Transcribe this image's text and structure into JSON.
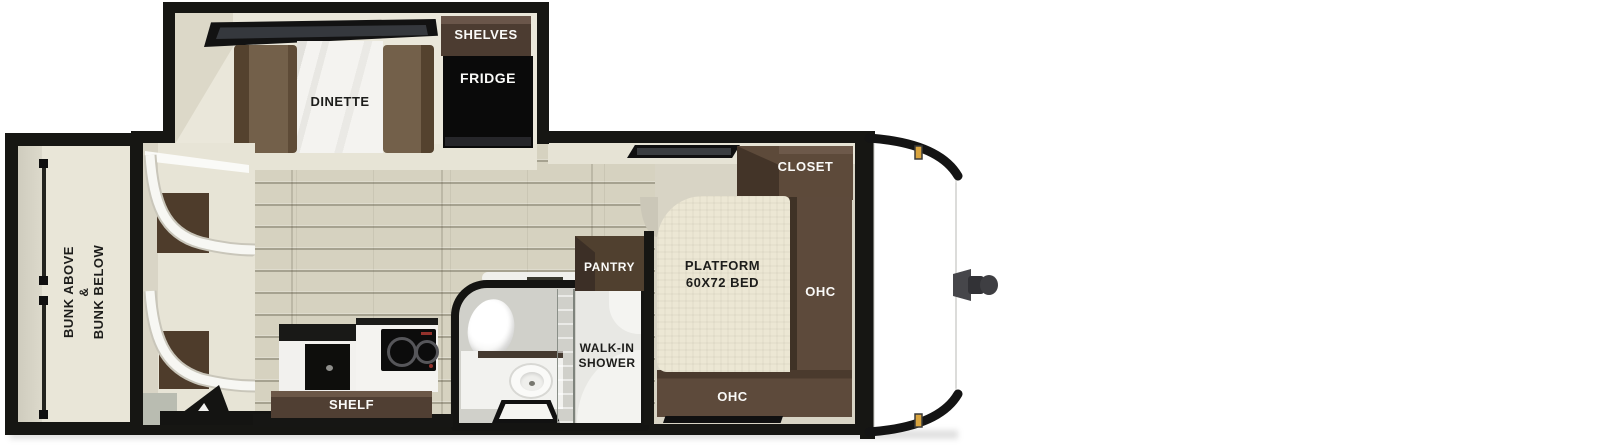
{
  "floorplan": {
    "bunk_room": {
      "label_lines": [
        "BUNK ABOVE",
        "&",
        "BUNK BELOW"
      ]
    },
    "slide_out": {
      "dinette": "DINETTE",
      "shelves": "SHELVES",
      "fridge": "FRIDGE"
    },
    "kitchen": {
      "shelf": "SHELF"
    },
    "bathroom": {
      "pantry": "PANTRY",
      "shower_lines": [
        "WALK-IN",
        "SHOWER"
      ]
    },
    "bedroom": {
      "closet": "CLOSET",
      "bed_lines": [
        "PLATFORM",
        "60X72 BED"
      ],
      "ohc_side": "OHC",
      "ohc_foot": "OHC"
    },
    "colors": {
      "wall": "#161613",
      "cabinet_dark": "#4f3e31",
      "cabinet": "#5d4a3b",
      "bench": "#73604a",
      "wood_floor": "#d6d2c0",
      "cream": "#e7e4d7",
      "marker_light": "#d9a43e",
      "glass": "#b7c6b6",
      "fridge": "#0a0a0a"
    }
  }
}
